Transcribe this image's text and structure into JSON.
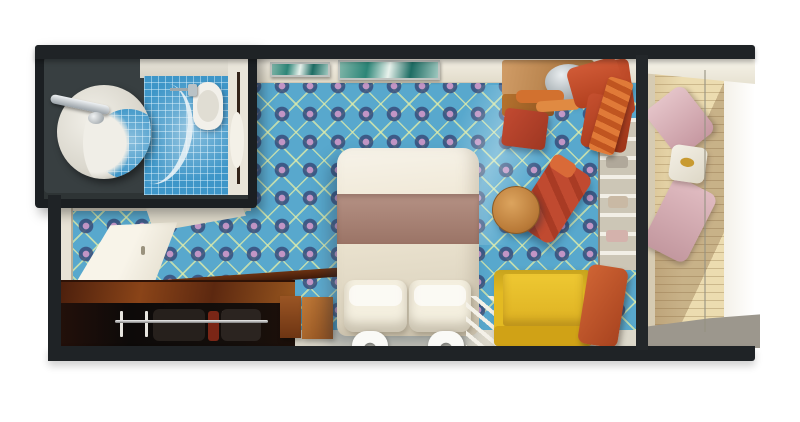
{
  "meta": {
    "type": "floor-plan-render",
    "subject": "Cruise ship balcony stateroom, top-down 3D cutaway floor plan",
    "canvas": {
      "width": 800,
      "height": 422
    },
    "visible_text": "none"
  },
  "palette": {
    "wall_dark": "#1f2326",
    "bath_interior": "#2e3435",
    "bath_tile": "#3e96c8",
    "wall_cream": "#f2eee2",
    "carpet_blue": "#58a8cd",
    "carpet_lattice": "#dceba2",
    "carpet_diamond": "#3f5886",
    "carpet_dot": "#b88cc2",
    "bed_linen": "#efe7d4",
    "bed_runner": "#a87e6f",
    "sofa_yellow": "#e3ba22",
    "accent_red": "#c0482e",
    "accent_orange": "#d2712f",
    "wood_light": "#c58441",
    "wood_dark": "#5c2810",
    "deck_wood": "#ecdcb0",
    "deck_chair_pink": "#d9b5bb",
    "floor_strip": "#dcd8ca",
    "ledge_gray": "#9c978d"
  },
  "rooms": {
    "bathroom": {
      "label": "Bathroom",
      "items": [
        "round-vanity-sink",
        "chrome-faucet",
        "curved-glass-shower-screen",
        "shower-head",
        "toilet",
        "blue-mosaic-tile-floor",
        "bathroom-door"
      ]
    },
    "entry": {
      "label": "Entry hall",
      "items": [
        "open-cabin-door",
        "door-frame",
        "open-closet-door",
        "dark-wardrobe",
        "clothes-rail",
        "hangers",
        "dark-wood-counter"
      ]
    },
    "bedroom": {
      "label": "Bedroom",
      "items": [
        "double-bed",
        "brown-bed-runner",
        "two-pillows",
        "two-bed-feet",
        "two-wood-nightstands",
        "two-wall-artworks",
        "diamond-pattern-blue-carpet"
      ]
    },
    "sitting_area": {
      "label": "Sitting area",
      "items": [
        "wood-vanity-desk",
        "silver-dome",
        "orange-towels",
        "red-desk-stool",
        "red-armchair-with-throw",
        "red-chaise-lounge",
        "round-wood-side-table",
        "yellow-sofa",
        "orange-cushion",
        "slatted-luggage-rack",
        "white-shelf-unit"
      ]
    },
    "balcony": {
      "label": "Balcony",
      "items": [
        "glass-partition-wall",
        "wood-plank-deck",
        "pink-deck-chair-forward",
        "pink-deck-chair-aft",
        "white-deck-table",
        "railing",
        "gray-deck-ledge"
      ]
    }
  },
  "counts": {
    "hangers": 6,
    "wall_artworks": 2,
    "pillows": 2,
    "deck_chairs": 2,
    "bed_feet": 2
  }
}
